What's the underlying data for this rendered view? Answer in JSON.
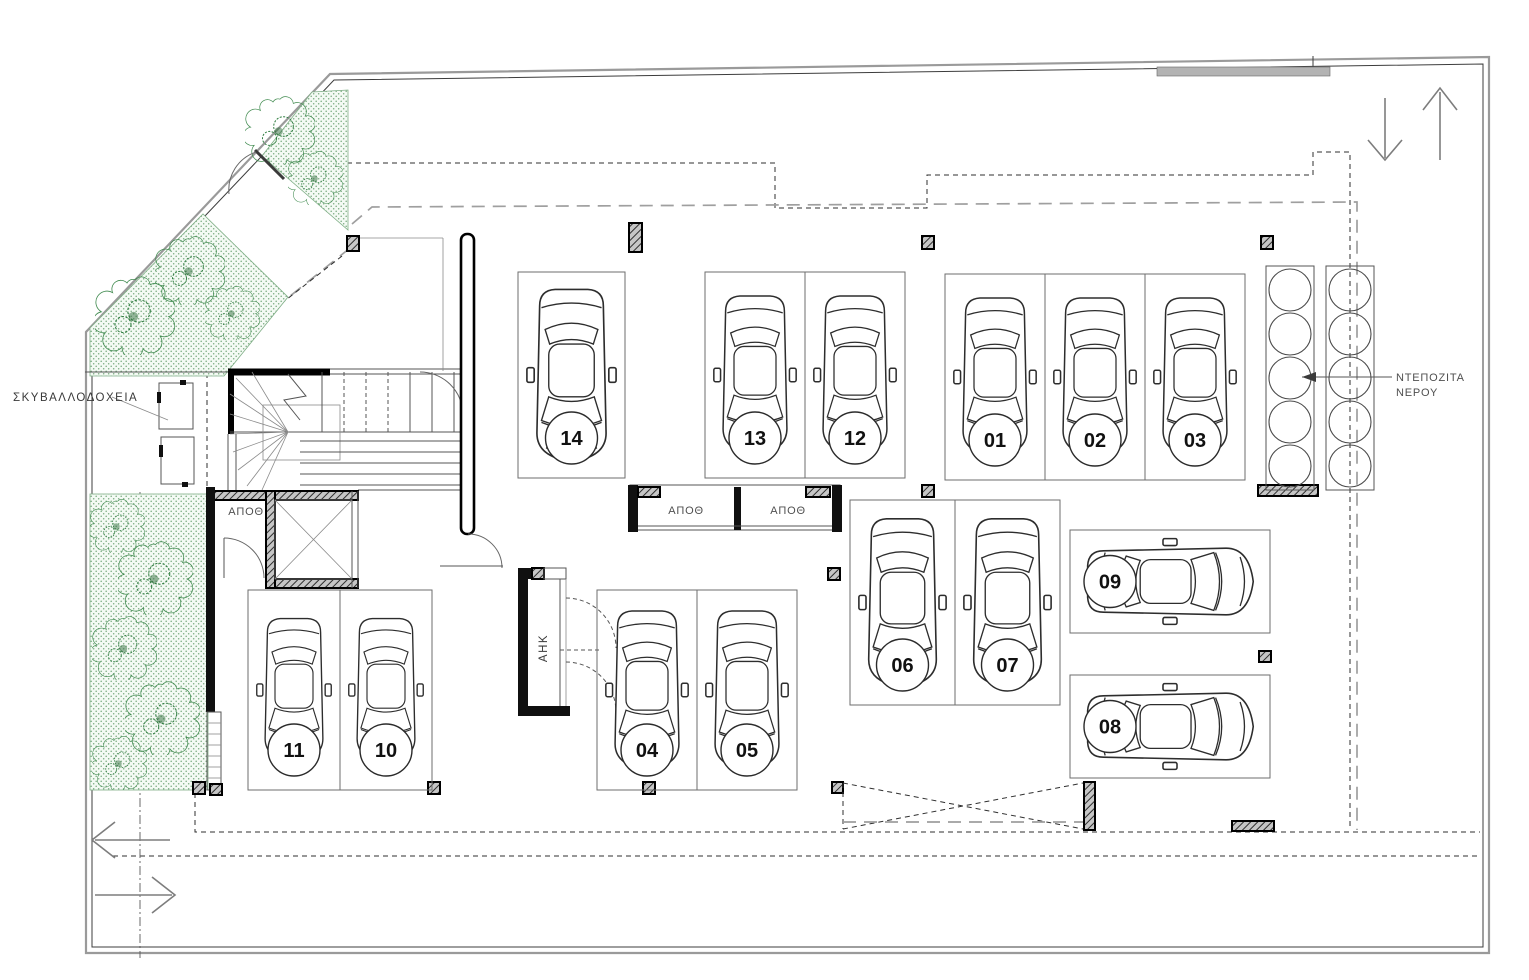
{
  "plan": {
    "labels": {
      "garbage_bins": "ΣΚΥΒΑΛΛΟΔΟΧΕΙΑ",
      "storage_room_left": "ΑΠΟΘ",
      "storage_room_1": "ΑΠΟΘ",
      "storage_room_2": "ΑΠΟΘ",
      "electrical_room": "ΑΗΚ",
      "water_tanks_label_line1": "ΝΤΕΠΟΖΙΤΑ",
      "water_tanks_label_line2": "ΝΕΡΟΥ"
    },
    "parking_spots": [
      {
        "label": "14",
        "x": 518,
        "y": 272,
        "w": 107,
        "h": 206,
        "orientation": "vertical"
      },
      {
        "label": "13",
        "x": 705,
        "y": 272,
        "w": 100,
        "h": 206,
        "orientation": "vertical"
      },
      {
        "label": "12",
        "x": 805,
        "y": 272,
        "w": 100,
        "h": 206,
        "orientation": "vertical"
      },
      {
        "label": "01",
        "x": 945,
        "y": 274,
        "w": 100,
        "h": 206,
        "orientation": "vertical"
      },
      {
        "label": "02",
        "x": 1045,
        "y": 274,
        "w": 100,
        "h": 206,
        "orientation": "vertical"
      },
      {
        "label": "03",
        "x": 1145,
        "y": 274,
        "w": 100,
        "h": 206,
        "orientation": "vertical"
      },
      {
        "label": "06",
        "x": 850,
        "y": 500,
        "w": 105,
        "h": 205,
        "orientation": "vertical"
      },
      {
        "label": "07",
        "x": 955,
        "y": 500,
        "w": 105,
        "h": 205,
        "orientation": "vertical"
      },
      {
        "label": "09",
        "x": 1070,
        "y": 530,
        "w": 200,
        "h": 103,
        "orientation": "horizontal"
      },
      {
        "label": "08",
        "x": 1070,
        "y": 675,
        "w": 200,
        "h": 103,
        "orientation": "horizontal"
      },
      {
        "label": "11",
        "x": 248,
        "y": 590,
        "w": 92,
        "h": 200,
        "orientation": "vertical"
      },
      {
        "label": "10",
        "x": 340,
        "y": 590,
        "w": 92,
        "h": 200,
        "orientation": "vertical"
      },
      {
        "label": "04",
        "x": 597,
        "y": 590,
        "w": 100,
        "h": 200,
        "orientation": "vertical"
      },
      {
        "label": "05",
        "x": 697,
        "y": 590,
        "w": 100,
        "h": 200,
        "orientation": "vertical"
      }
    ],
    "water_tanks": {
      "diameter": 44,
      "columns": [
        {
          "x": 1268,
          "y": 268,
          "count": 5
        },
        {
          "x": 1328,
          "y": 268,
          "count": 5
        }
      ]
    },
    "colors": {
      "planting_stroke": "#3f8a4e",
      "planting_dots": "#79ab80",
      "line": "#3c3c3c",
      "wall": "#101010",
      "gray_dash": "#9f9f9f"
    }
  }
}
